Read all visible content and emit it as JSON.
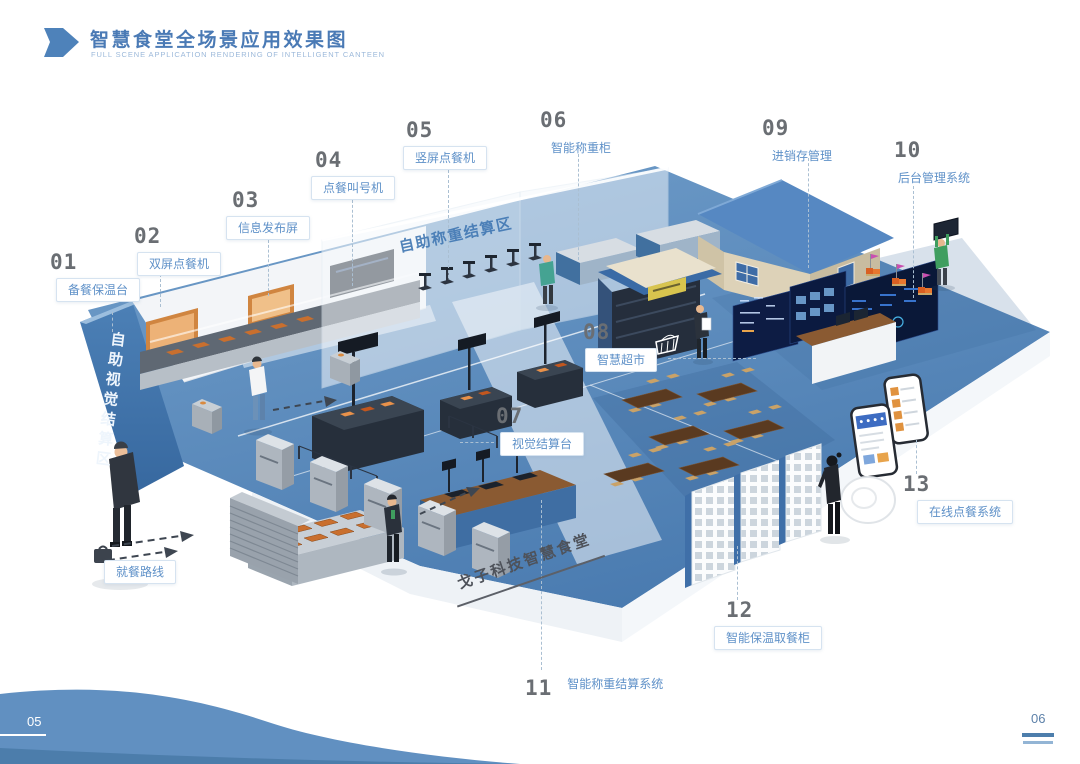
{
  "header": {
    "title": "智慧食堂全场景应用效果图",
    "subtitle": "FULL SCENE APPLICATION RENDERING OF INTELLIGENT CANTEEN"
  },
  "callouts": [
    {
      "num": "01",
      "label": "备餐保温台"
    },
    {
      "num": "02",
      "label": "双屏点餐机"
    },
    {
      "num": "03",
      "label": "信息发布屏"
    },
    {
      "num": "04",
      "label": "点餐叫号机"
    },
    {
      "num": "05",
      "label": "竖屏点餐机"
    },
    {
      "num": "06",
      "label": "智能称重柜"
    },
    {
      "num": "07",
      "label": "视觉结算台"
    },
    {
      "num": "08",
      "label": "智慧超市"
    },
    {
      "num": "09",
      "label": "进销存管理"
    },
    {
      "num": "10",
      "label": "后台管理系统"
    },
    {
      "num": "11",
      "label": "智能称重结算系统"
    },
    {
      "num": "12",
      "label": "智能保温取餐柜"
    },
    {
      "num": "13",
      "label": "在线点餐系统"
    }
  ],
  "scene": {
    "zone_wall": "自助视觉结算区",
    "zone_glass": "自助称重结算区",
    "floor_brand": "戈子科技智慧食堂",
    "route_label": "就餐路线"
  },
  "footer": {
    "page_left": "05",
    "page_right": "06"
  },
  "colors": {
    "accent_blue": "#4a7ab5",
    "floor_blue": "#4b7db2",
    "label_blue": "#5f91c8",
    "wave_blue": "#6190c1"
  }
}
